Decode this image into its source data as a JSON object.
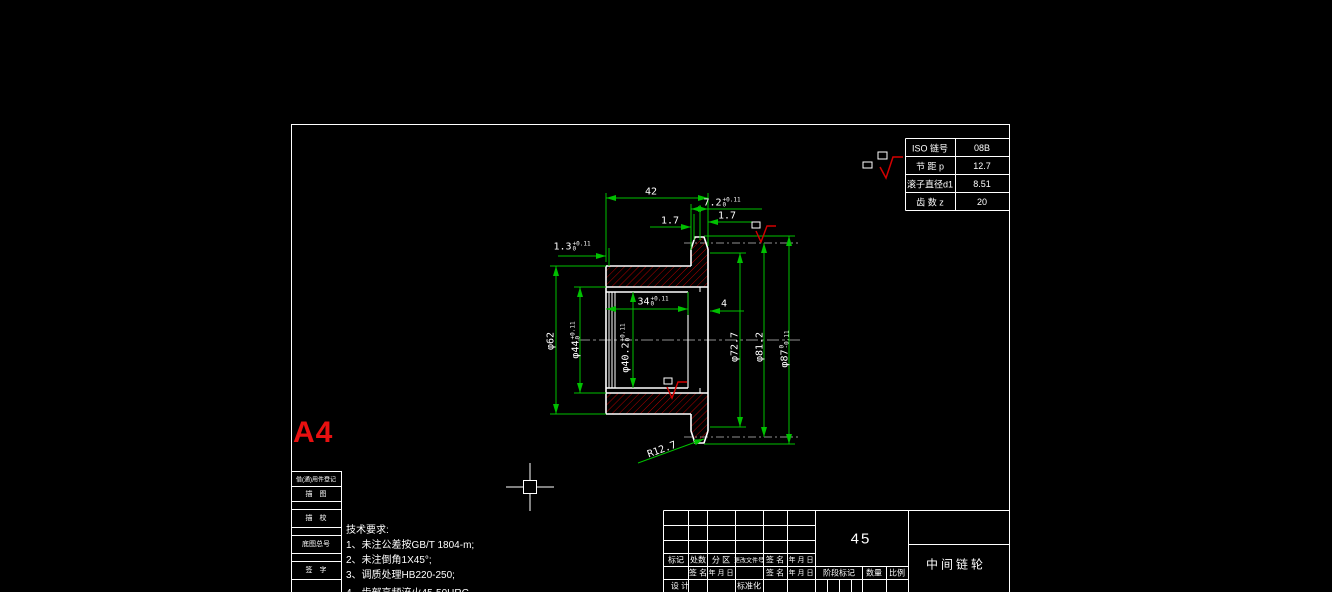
{
  "colors": {
    "background": "#000000",
    "outline": "#ffffff",
    "dimension": "#00c000",
    "hatch": "#b40000",
    "accent_red": "#e81010",
    "centerline": "#909090"
  },
  "sheet": {
    "format": "A4",
    "material": "45",
    "part_name": "中间链轮"
  },
  "param_table": {
    "rows": [
      {
        "label": "ISO 链号",
        "value": "08B"
      },
      {
        "label": "节 距 p",
        "value": "12.7"
      },
      {
        "label": "滚子直径d1",
        "value": "8.51"
      },
      {
        "label": "齿 数 z",
        "value": "20"
      }
    ]
  },
  "tech_req": {
    "title": "技术要求:",
    "items": [
      "1、未注公差按GB/T 1804-m;",
      "2、未注倒角1X45°;",
      "3、调质处理HB220-250;",
      "4、齿部高频淬火45-50HRC"
    ]
  },
  "edge_fields": {
    "f1": "借(通)用件登记",
    "f2": "描　图",
    "f3": "描　校",
    "f4": "底图总号",
    "f5": "签　字"
  },
  "title_block": {
    "h_mark": "标记",
    "h_count": "处数",
    "h_zone": "分 区",
    "h_doc": "更改文件号",
    "h_sign": "签 名",
    "h_date": "年 月 日",
    "r2_sign": "签 名",
    "r2_date": "年 月 日",
    "r2_sign2": "签 名",
    "r2_date2": "年 月 日",
    "design": "设 计",
    "standard": "标准化",
    "stage": "阶段标记",
    "qty": "数量",
    "scale": "比例"
  },
  "dims": {
    "w42": "42",
    "w72": {
      "v": "7.2",
      "sup": "+0.11",
      "sub": "0"
    },
    "w17a": "1.7",
    "w17b": "1.7",
    "w13": {
      "v": "1.3",
      "sup": "+0.11",
      "sub": "0"
    },
    "w34": {
      "v": "34",
      "sup": "+0.11",
      "sub": "0"
    },
    "w4": "4",
    "dia62": "φ62",
    "dia44": {
      "v": "φ44",
      "sup": "+0.11",
      "sub": "0"
    },
    "dia402": {
      "v": "φ40.2",
      "sup": "+0.11",
      "sub": "0"
    },
    "dia727": "φ72.7",
    "dia812": "φ81.2",
    "dia87": {
      "v": "φ87",
      "sup": "0",
      "sub": "-0.11"
    },
    "r127": "R12.7"
  }
}
